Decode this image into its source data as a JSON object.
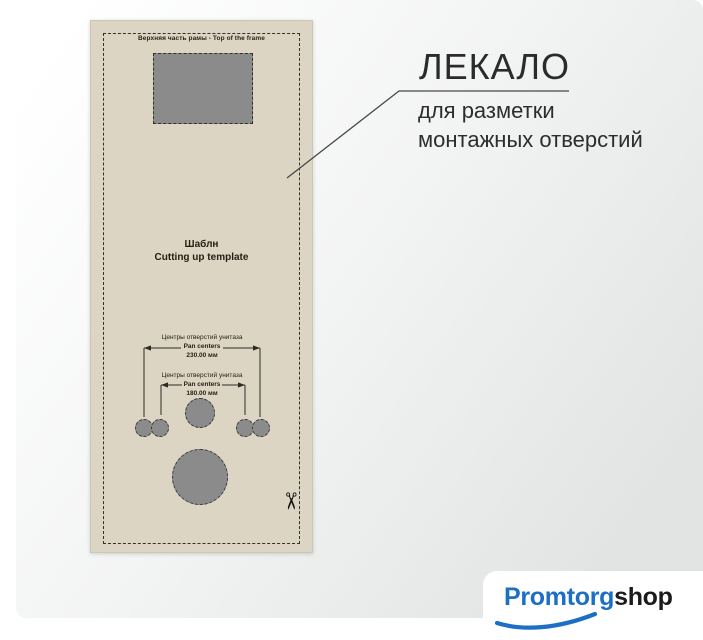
{
  "template": {
    "top_label": "Верхняя часть рамы - Top of the frame",
    "title_ru": "Шаблн",
    "title_en": "Cutting up template",
    "dimensions": [
      {
        "label_ru": "Центры отверстий унитаза",
        "label_en": "Pan centers",
        "value": "230.00 мм"
      },
      {
        "label_ru": "Центры отверстий унитаза",
        "label_en": "Pan centers",
        "value": "180.00 мм"
      }
    ]
  },
  "annotation": {
    "title": "ЛЕКАЛО",
    "line1": "для разметки",
    "line2": "монтажных отверстий"
  },
  "logo": {
    "part1": "Promtorg",
    "part2": "shop"
  },
  "icons": {
    "scissors": "✂"
  },
  "colors": {
    "template_paper": "#dcd5c4",
    "cutout_gray": "#8b8b8b",
    "ink": "#2e2a24",
    "logo_blue": "#1c6fc4"
  }
}
